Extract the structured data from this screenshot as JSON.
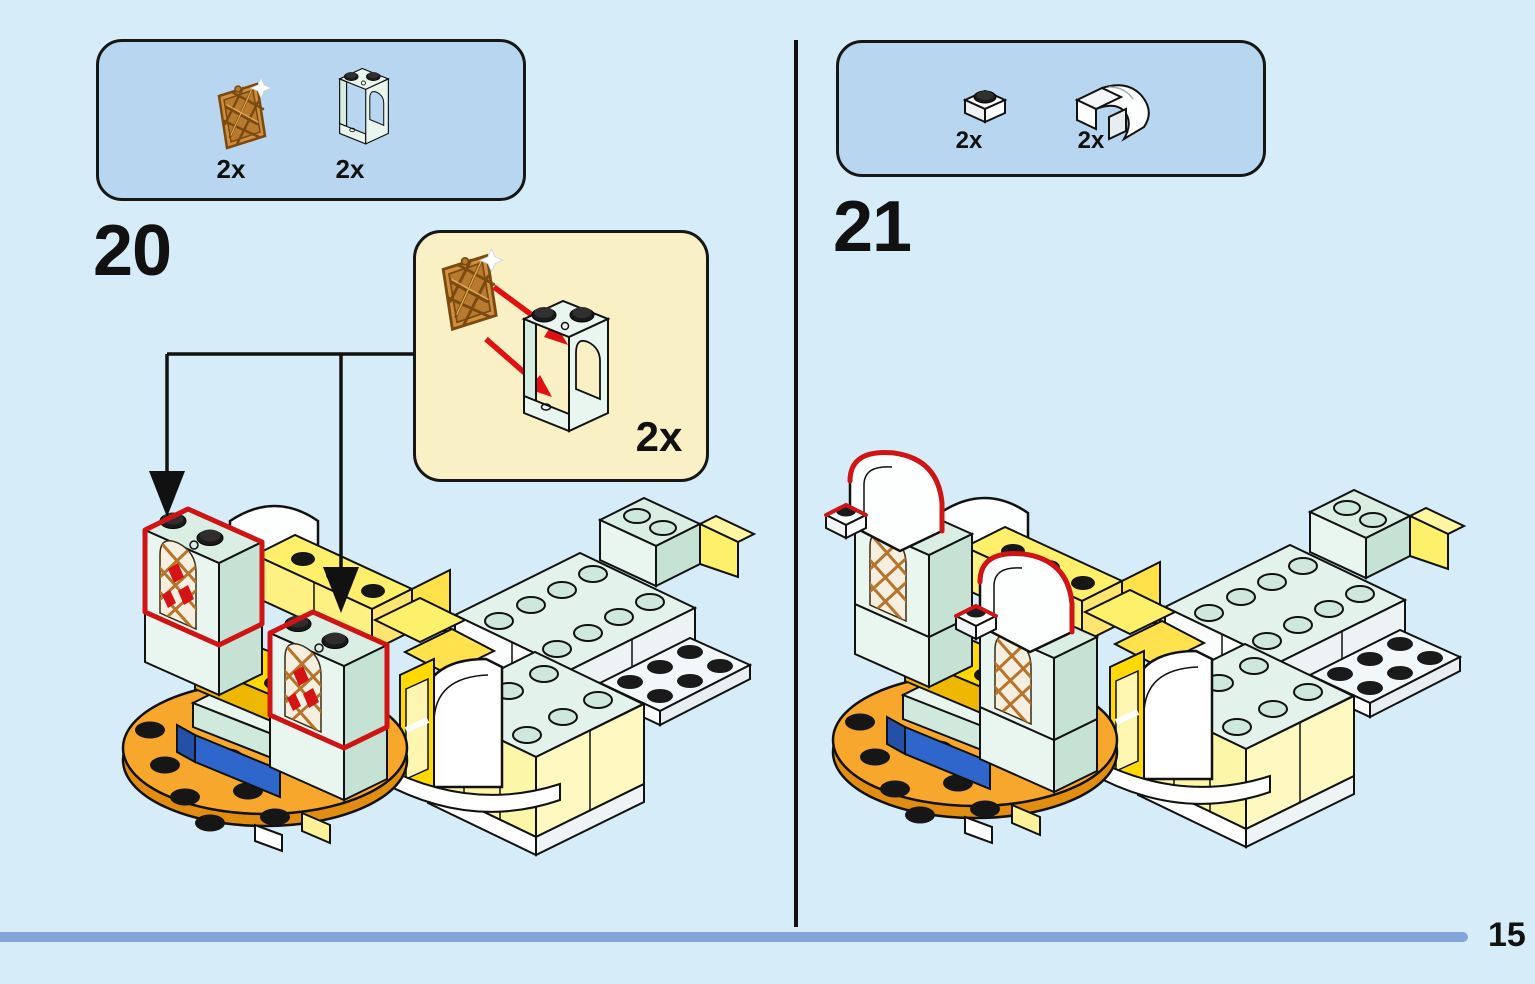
{
  "page": {
    "number": "15"
  },
  "steps": [
    {
      "number": "20",
      "parts": [
        {
          "name": "lattice window 1x2x2 copper",
          "count": "2x"
        },
        {
          "name": "window frame 1x2x2 mint with arch",
          "count": "2x"
        }
      ],
      "callout": {
        "count": "2x",
        "meaning": "insert lattice window into window frame, build 2 copies"
      }
    },
    {
      "number": "21",
      "parts": [
        {
          "name": "plate 1x1 white",
          "count": "2x"
        },
        {
          "name": "curved slope 1x2 white",
          "count": "2x"
        }
      ]
    }
  ],
  "colors": {
    "background": "#d7ecf9",
    "parts_panel_blue": "#b9d6f0",
    "callout_cream": "#faf0c6",
    "highlight_red": "#cf1415",
    "arrow_red": "#e01111",
    "progress_bar": "#84a4d8",
    "orange_base": "#f7a82c",
    "mint_piece": "#e9f5ef",
    "yellow_piece": "#fdf06a",
    "bright_yellow_piece": "#ffd906",
    "blue_piece": "#2e66cc",
    "copper_lattice": "#c8883a"
  }
}
